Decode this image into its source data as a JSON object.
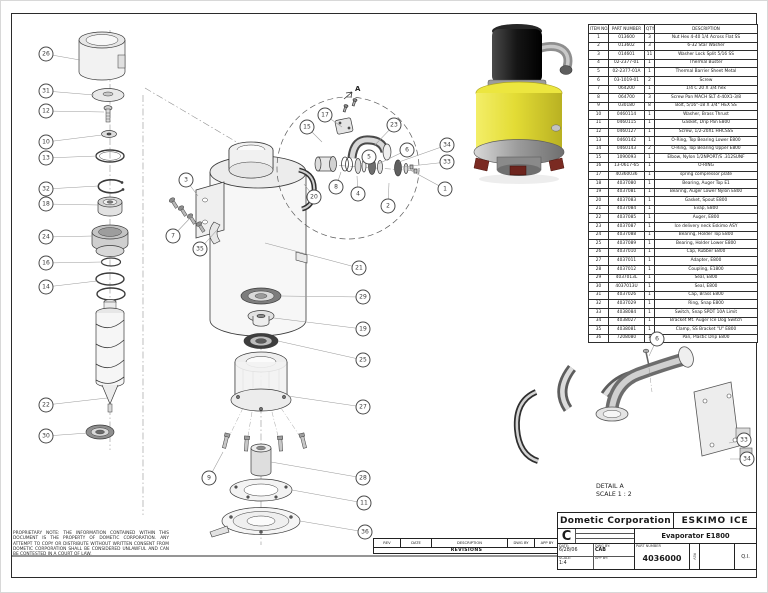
{
  "bom": {
    "headers": [
      "ITEM NO.",
      "PART NUMBER",
      "QTY.",
      "DESCRIPTION"
    ],
    "rows": [
      [
        "1",
        "013600",
        "3",
        "Nut Hex 4-40 1/4 Across Flat SS"
      ],
      [
        "2",
        "013602",
        "3",
        "6-32 Star Washer"
      ],
      [
        "3",
        "014601",
        "11",
        "Washer Lock Split 5/16 SS"
      ],
      [
        "4",
        "02-2377-01",
        "1",
        "Thermal Buster"
      ],
      [
        "5",
        "02-2377-01A",
        "1",
        "Thermal Barrier Sheet Metal"
      ],
      [
        "6",
        "03-1019-01",
        "2",
        "Screw"
      ],
      [
        "7",
        "064200",
        "1",
        "1/4 C 20 X 3/4 hex"
      ],
      [
        "8",
        "064700",
        "3",
        "Screw Pan MACH SLT 4-40X1-3/8"
      ],
      [
        "9",
        "030180",
        "8",
        "Bolt, 5/16\"-18 X 3/4\" HEX SS"
      ],
      [
        "10",
        "0460114",
        "1",
        "Washer, Brass Thrust"
      ],
      [
        "11",
        "0460115",
        "1",
        "Gasket, Drip Pan E800"
      ],
      [
        "12",
        "0460127",
        "1",
        "Screw, 1/2-20X1 HHCSSS"
      ],
      [
        "13",
        "0460142",
        "1",
        "O-Ring, Top Bearing Lower E800"
      ],
      [
        "14",
        "0460143",
        "2",
        "O-Ring, Top Bearing Upper E800"
      ],
      [
        "15",
        "1090093",
        "1",
        "Elbow, Nylon 1/2NPORT/S .312SUNF"
      ],
      [
        "16",
        "13-0617-65",
        "1",
        "O-RING"
      ],
      [
        "17",
        "40360036",
        "1",
        "spring compressor plate"
      ],
      [
        "18",
        "4037080",
        "1",
        "Bearing, Auger Top E1"
      ],
      [
        "19",
        "4037081",
        "1",
        "Bearing, Auger Lower Nylon E800"
      ],
      [
        "20",
        "4037083",
        "1",
        "Gasket, Spout E800"
      ],
      [
        "21",
        "4037084",
        "1",
        "Evap, E800"
      ],
      [
        "22",
        "4037085",
        "1",
        "Auger, E800"
      ],
      [
        "23",
        "4037087",
        "1",
        "Ice delivery neck Eskimo ASY"
      ],
      [
        "24",
        "4037088",
        "1",
        "Bearing, Holder Top E800"
      ],
      [
        "25",
        "4037089",
        "1",
        "Bearing, Holder Lower E800"
      ],
      [
        "26",
        "4037010",
        "1",
        "Cap, Rubber E800"
      ],
      [
        "27",
        "4037011",
        "1",
        "Adapter, E800"
      ],
      [
        "28",
        "4037012",
        "1",
        "Coupling, E1800"
      ],
      [
        "29",
        "4037013L",
        "1",
        "Seal, E800"
      ],
      [
        "30",
        "4037013U",
        "1",
        "Seal, E800"
      ],
      [
        "31",
        "4037026",
        "1",
        "Cap, Brass E800"
      ],
      [
        "32",
        "4037029",
        "1",
        "Ring, Snap E800"
      ],
      [
        "33",
        "4038084",
        "1",
        "Switch, Snap SPDT 10A Limit"
      ],
      [
        "34",
        "4038027",
        "1",
        "Bracket Mt. Auger Ice Dog Switch"
      ],
      [
        "35",
        "4038081",
        "1",
        "Clamp, SS Bracket \"U\" E800"
      ],
      [
        "36",
        "7208080",
        "1",
        "Pan, Plastic Drip E800"
      ]
    ]
  },
  "title_block": {
    "company": "Dometic Corporation",
    "product": "ESKIMO ICE",
    "size": "C",
    "drawing_title": "Evaporator E1800",
    "date_label": "DATE:",
    "date": "6/28/06",
    "dwg_by_label": "DWG BY:",
    "dwg_by": "CAB",
    "scale_label": "SCALE:",
    "scale": "1:4",
    "app_by_label": "APP BY:",
    "part_number_label": "PART NUMBER",
    "part_number": "4036000",
    "rev_label": "REV",
    "qi": "Q.I."
  },
  "revisions": {
    "title": "REVISIONS",
    "headers": [
      "REV",
      "DATE",
      "DESCRIPTION",
      "DWG BY",
      "APP BY"
    ]
  },
  "proprietary_note": "PROPRIETARY NOTE: THE INFORMATION CONTAINED WITHIN THIS DOCUMENT IS THE PROPERTY OF DOMETIC CORPORATION. ANY ATTEMPT TO COPY OR DISTRIBUTE WITHOUT WRITTEN CONSENT FROM DOMETIC CORPORATION SHALL BE CONSIDERED UNLAWFUL AND CAN BE CONTESTED IN A COURT OF LAW.",
  "detail": {
    "label": "DETAIL A",
    "scale": "SCALE 1 : 2",
    "marker": "A"
  },
  "colors": {
    "body_yellow": "#e3dc35",
    "motor_black": "#1b1b1b",
    "metal_grey": "#9a9a9a",
    "foot_red": "#7a2a22",
    "ink": "#2b2b2b"
  },
  "balloons": [
    {
      "n": "26",
      "x": 46,
      "y": 54,
      "tx": 80,
      "ty": 60
    },
    {
      "n": "31",
      "x": 46,
      "y": 91,
      "tx": 94,
      "ty": 95
    },
    {
      "n": "12",
      "x": 46,
      "y": 111,
      "tx": 104,
      "ty": 112
    },
    {
      "n": "10",
      "x": 46,
      "y": 142,
      "tx": 102,
      "ty": 135
    },
    {
      "n": "13",
      "x": 46,
      "y": 158,
      "tx": 97,
      "ty": 156
    },
    {
      "n": "32",
      "x": 46,
      "y": 189,
      "tx": 98,
      "ty": 186
    },
    {
      "n": "18",
      "x": 46,
      "y": 204,
      "tx": 99,
      "ty": 205
    },
    {
      "n": "24",
      "x": 46,
      "y": 237,
      "tx": 93,
      "ty": 236
    },
    {
      "n": "16",
      "x": 46,
      "y": 263,
      "tx": 102,
      "ty": 262
    },
    {
      "n": "14",
      "x": 46,
      "y": 287,
      "tx": 97,
      "ty": 281
    },
    {
      "n": "22",
      "x": 46,
      "y": 405,
      "tx": 107,
      "ty": 398
    },
    {
      "n": "30",
      "x": 46,
      "y": 436,
      "tx": 88,
      "ty": 433
    },
    {
      "n": "3",
      "x": 186,
      "y": 180,
      "tx": 198,
      "ty": 196
    },
    {
      "n": "7",
      "x": 173,
      "y": 236,
      "tx": 192,
      "ty": 216
    },
    {
      "n": "35",
      "x": 200,
      "y": 249,
      "tx": 217,
      "ty": 230
    },
    {
      "n": "20",
      "x": 314,
      "y": 197,
      "tx": 304,
      "ty": 184
    },
    {
      "n": "21",
      "x": 359,
      "y": 268,
      "tx": 265,
      "ty": 243
    },
    {
      "n": "17",
      "x": 325,
      "y": 115,
      "tx": 342,
      "ty": 127
    },
    {
      "n": "15",
      "x": 307,
      "y": 127,
      "tx": 322,
      "ty": 142
    },
    {
      "n": "23",
      "x": 394,
      "y": 125,
      "tx": 374,
      "ty": 146
    },
    {
      "n": "5",
      "x": 369,
      "y": 157,
      "tx": 360,
      "ty": 165
    },
    {
      "n": "6",
      "x": 407,
      "y": 150,
      "tx": 378,
      "ty": 164
    },
    {
      "n": "34",
      "x": 447,
      "y": 145,
      "tx": 399,
      "ty": 162
    },
    {
      "n": "33",
      "x": 447,
      "y": 162,
      "tx": 402,
      "ty": 167
    },
    {
      "n": "1",
      "x": 445,
      "y": 189,
      "tx": 410,
      "ty": 170
    },
    {
      "n": "2",
      "x": 388,
      "y": 206,
      "tx": 389,
      "ty": 183
    },
    {
      "n": "4",
      "x": 358,
      "y": 194,
      "tx": 357,
      "ty": 176
    },
    {
      "n": "8",
      "x": 336,
      "y": 187,
      "tx": 341,
      "ty": 172
    },
    {
      "n": "29",
      "x": 363,
      "y": 297,
      "tx": 281,
      "ty": 296
    },
    {
      "n": "19",
      "x": 363,
      "y": 329,
      "tx": 274,
      "ty": 318
    },
    {
      "n": "25",
      "x": 363,
      "y": 360,
      "tx": 278,
      "ty": 341
    },
    {
      "n": "27",
      "x": 363,
      "y": 407,
      "tx": 288,
      "ty": 396
    },
    {
      "n": "9",
      "x": 209,
      "y": 478,
      "tx": 223,
      "ty": 452
    },
    {
      "n": "28",
      "x": 363,
      "y": 478,
      "tx": 271,
      "ty": 462
    },
    {
      "n": "11",
      "x": 364,
      "y": 503,
      "tx": 292,
      "ty": 490
    },
    {
      "n": "36",
      "x": 365,
      "y": 532,
      "tx": 300,
      "ty": 521
    },
    {
      "n": "6",
      "x": 657,
      "y": 339,
      "tx": 649,
      "ty": 356
    },
    {
      "n": "33",
      "x": 744,
      "y": 440,
      "tx": 729,
      "ty": 443
    },
    {
      "n": "34",
      "x": 747,
      "y": 459,
      "tx": 730,
      "ty": 459
    }
  ]
}
